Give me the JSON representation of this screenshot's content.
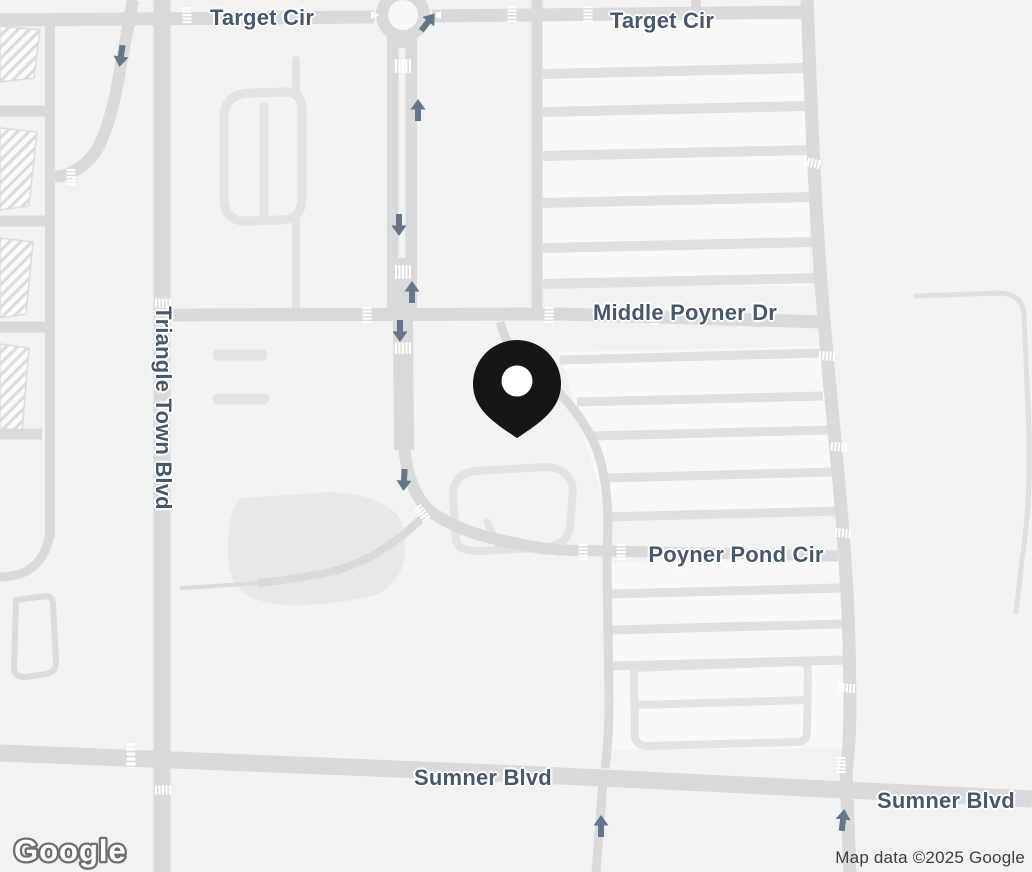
{
  "map": {
    "streets": {
      "target_cir_west": "Target Cir",
      "target_cir_east": "Target Cir",
      "middle_poyner_dr": "Middle Poyner Dr",
      "triangle_town_blvd": "Triangle Town Blvd",
      "poyner_pond_cir": "Poyner Pond Cir",
      "sumner_blvd_west": "Sumner Blvd",
      "sumner_blvd_east": "Sumner Blvd"
    },
    "marker": {
      "kind": "location-pin",
      "color": "#161616"
    },
    "branding": {
      "logo_text": "Google"
    },
    "attribution_text": "Map data ©2025 Google",
    "theme": {
      "background": "#f1f2f2",
      "road_major": "#d9dadb",
      "road_minor": "#e2e3e3",
      "block_light": "#f8f8f7",
      "pond": "#e8e9e6",
      "label_text": "#47586c",
      "arrow": "#65758a",
      "crosswalk": "#ffffff"
    }
  }
}
